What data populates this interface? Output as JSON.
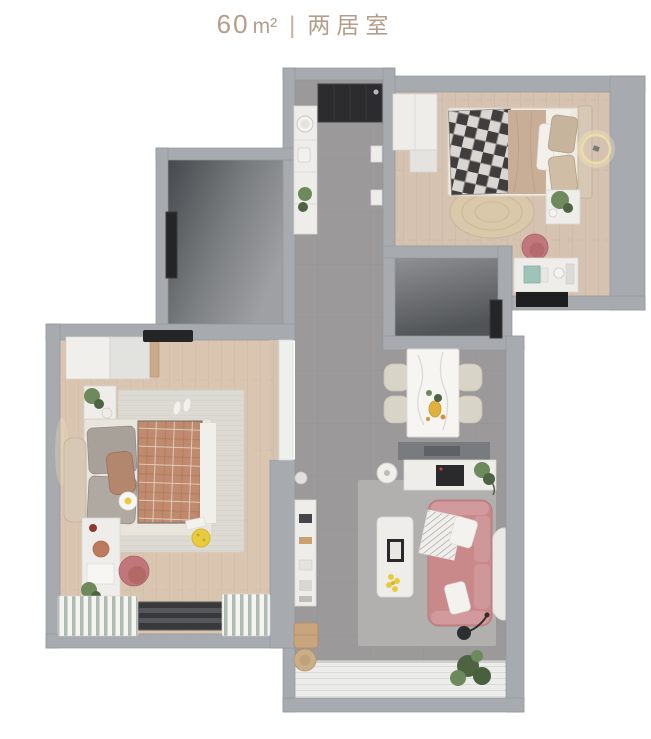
{
  "header": {
    "area_value": "60",
    "area_unit": "m²",
    "separator": "|",
    "layout_type": "两居室"
  },
  "colors": {
    "title": "#b49e89",
    "wall": "#a7abb0",
    "wall-edge": "#91969b",
    "tile": "#9c999b",
    "tile-line": "#8f8c8e",
    "wood": "#d5c2b0",
    "wood-line": "#c6b29f",
    "deck": "#ececea",
    "deck-line": "#d0d0cd",
    "white": "#efedea",
    "white-edge": "#d9d7d2",
    "marble": "#f6f5f2",
    "chair-beige": "#d8d5c8",
    "sofa": "#c9898b",
    "sofa-light": "#d29a9c",
    "chair-pink": "#c0767b",
    "blanket": "#bf8a6d",
    "blanket-line": "#a9735a",
    "duvet": "#c8ae97",
    "plaid-dark": "#3f3e3c",
    "plaid-light": "#dad7d2",
    "rug-light": "#dcdad2",
    "rug-jute": "#d9c8aa",
    "rug-gray": "#b5b3b0",
    "window": "#39393b",
    "glow": "#f0e3b8",
    "yellow": "#e9cb3e",
    "green": "#6d8a5c",
    "green-dark": "#4d6342",
    "headboard": "#d6c8b5",
    "stool-wood": "#c9a57e",
    "curtain-stripe": "#a4b1a7",
    "dark-item": "#242527"
  },
  "floorplan": {
    "rooms": [
      {
        "name": "kitchen-hallway",
        "items": [
          "cooktop",
          "counter-with-sink",
          "plants",
          "wall-shelves"
        ]
      },
      {
        "name": "second-bedroom",
        "items": [
          "wardrobe",
          "single-bed-plaid-blanket",
          "ring-wall-light",
          "nightstand-plant",
          "round-jute-rug",
          "desk",
          "pink-desk-chair"
        ]
      },
      {
        "name": "bathroom",
        "items": [
          "dark-door"
        ]
      },
      {
        "name": "storage-room",
        "items": [
          "wall-mirror"
        ]
      },
      {
        "name": "master-bedroom",
        "items": [
          "wardrobe",
          "ac-vent",
          "double-bed-terracotta-plaid",
          "daisy-cushion",
          "nightstand-plant",
          "striped-rug",
          "slippers",
          "desk",
          "pink-chair",
          "curtains",
          "window",
          "sliding-door"
        ]
      },
      {
        "name": "living-dining",
        "items": [
          "dining-table-marble",
          "four-chairs",
          "sideboard-coffee-machine",
          "robot-vacuum",
          "tv-console",
          "coffee-table-flowers",
          "pink-sofa",
          "floor-lamp",
          "plants",
          "wood-stools",
          "round-rug"
        ]
      },
      {
        "name": "balcony",
        "items": [
          "white-slat-deck",
          "plant"
        ]
      }
    ]
  }
}
